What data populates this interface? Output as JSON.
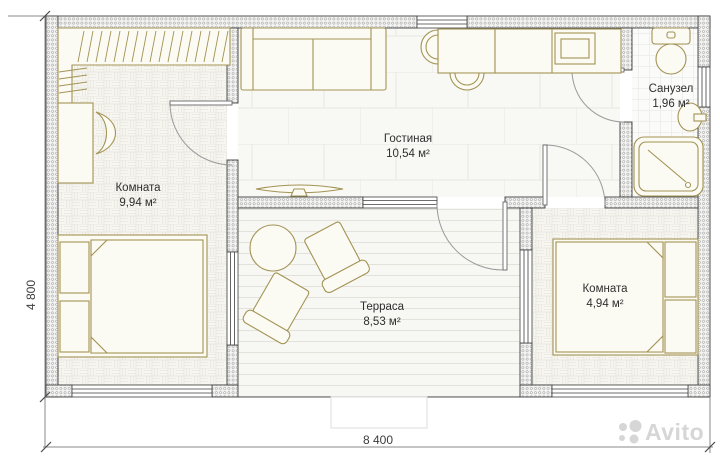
{
  "rooms": [
    {
      "id": "room-left",
      "name": "Комната",
      "area": "9,94 м²"
    },
    {
      "id": "living-room",
      "name": "Гостиная",
      "area": "10,54 м²"
    },
    {
      "id": "bathroom",
      "name": "Санузел",
      "area": "1,96 м²"
    },
    {
      "id": "terrace",
      "name": "Терраса",
      "area": "8,53 м²"
    },
    {
      "id": "room-right",
      "name": "Комната",
      "area": "4,94 м²"
    }
  ],
  "dimensions": {
    "width_label": "8 400",
    "height_label": "4 800"
  },
  "watermark": {
    "brand": "Avito"
  },
  "furniture_icons": [
    "wardrobe-icon",
    "desk-icon",
    "desk-chair-icon",
    "double-bed-icon",
    "sofa-icon",
    "tv-icon",
    "dining-table-icon",
    "dining-chair-icon",
    "kitchen-counter-icon",
    "kitchen-sink-icon",
    "toilet-icon",
    "washbasin-icon",
    "shower-icon",
    "coffee-table-icon",
    "armchair-icon",
    "entrance-step-icon"
  ],
  "colors": {
    "furniture_outline": "#a39355",
    "furniture_fill": "#fcfbf3",
    "wall_border": "#3f3f3f",
    "wall_dot": "#9e9e9e",
    "door_arc": "#9a9a9a",
    "label_text": "#2f2f2f",
    "dimension_text": "#3d3d3d",
    "watermark_gray": "#d6d6d6"
  }
}
